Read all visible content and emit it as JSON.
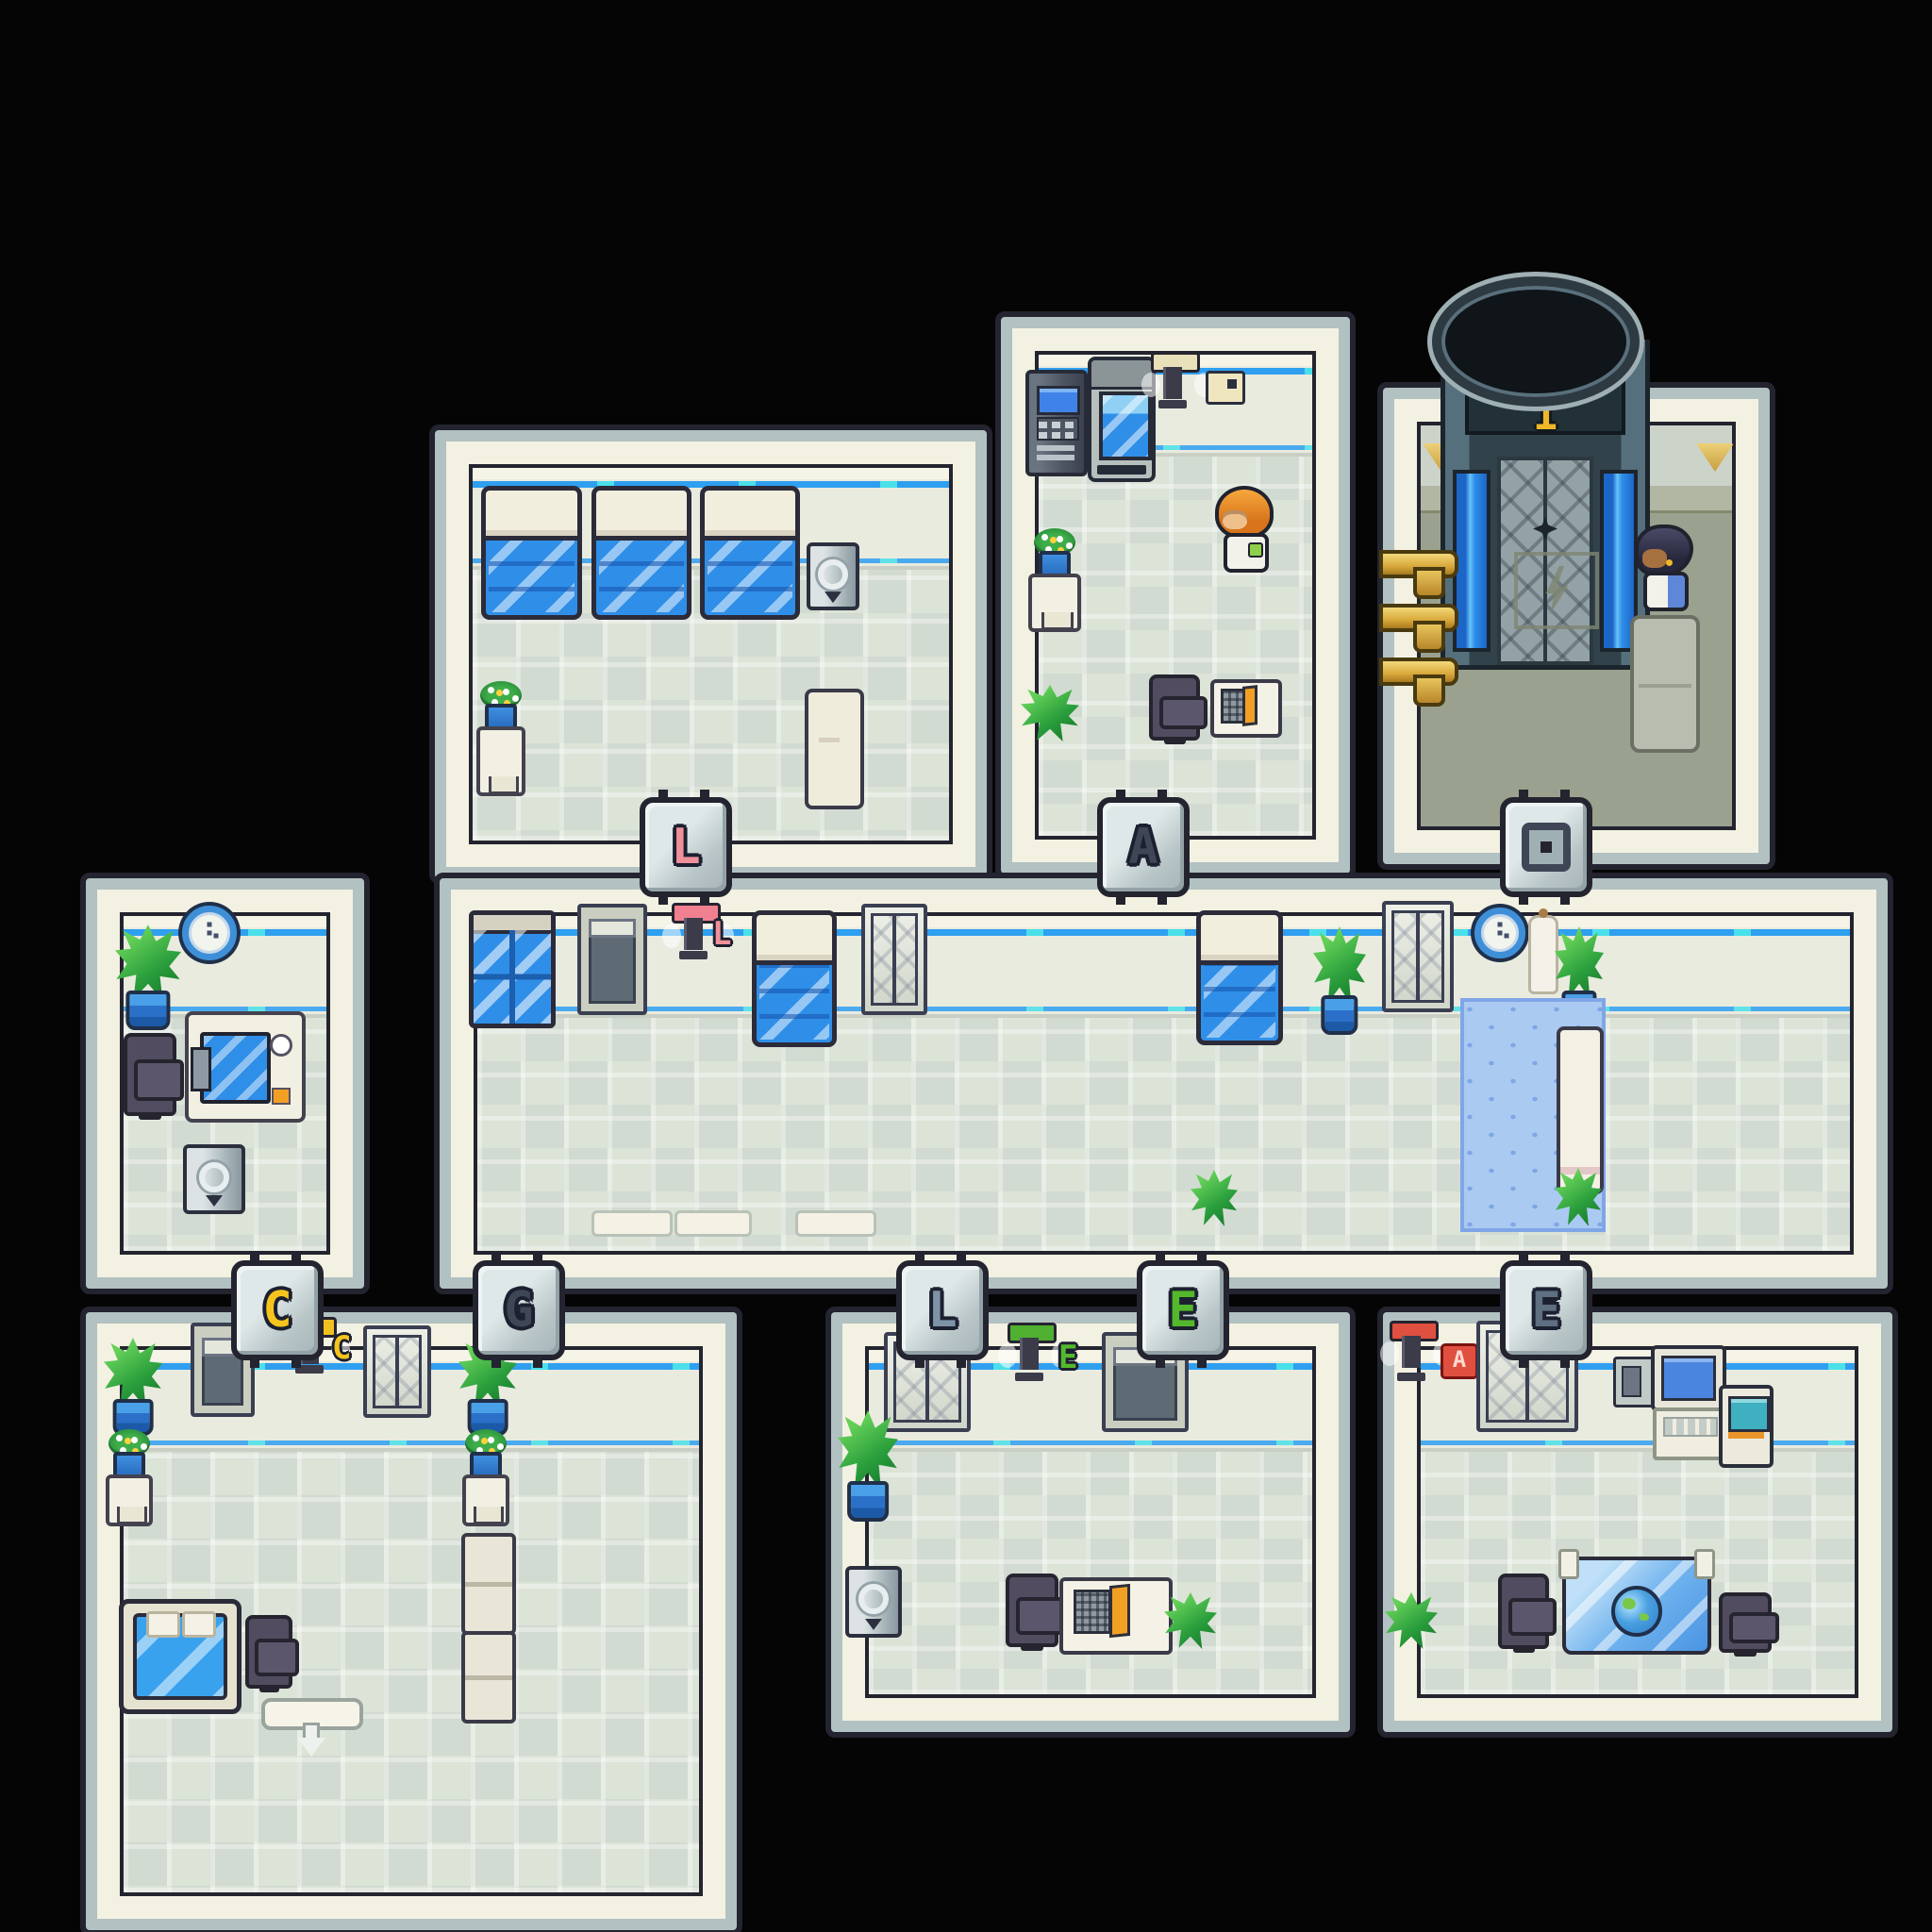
{
  "scene": {
    "type": "pixel-art facility floor map, top-down",
    "background_color": "#050505",
    "palette": {
      "wall_cream": "#f3f1e1",
      "frame_gray": "#b2c1c1",
      "outline_dark": "#23242f",
      "wall_stripe_blue": "#2f9ff0",
      "wall_stripe_cyan": "#49e0ea",
      "floor_tile": "#d6ded3",
      "elevator_hall_floor": "#9aa28f",
      "bed_blanket_blue": "#2f8fe8",
      "plant_green": "#2a9e3c",
      "pot_blue": "#2a70c8",
      "gold": "#d9a93c",
      "pool_blue": "#abcaf1"
    }
  },
  "elevator": {
    "floor_label": "1",
    "floor_plate_icon": "lightning-bolt"
  },
  "markers": {
    "top": [
      {
        "glyph": "L",
        "color": "#f0909a",
        "between": "ward and corridor"
      },
      {
        "glyph": "A",
        "color": "#3f4656",
        "between": "supply room and corridor"
      },
      {
        "glyph": "elevator-plate",
        "color": "#3f4656",
        "between": "elevator hall and corridor"
      }
    ],
    "bottom": [
      {
        "glyph": "C",
        "color": "#f6c51d",
        "between": "west office and lounge"
      },
      {
        "glyph": "G",
        "color": "#3f4656",
        "between": "corridor and lounge"
      },
      {
        "glyph": "L",
        "color": "#7e94a6",
        "between": "corridor and east office"
      },
      {
        "glyph": "E",
        "color": "#54b82d",
        "between": "corridor and east office"
      },
      {
        "glyph": "E",
        "color": "#5d6f80",
        "between": "corridor and computer lab"
      }
    ]
  },
  "signs": {
    "corridor": {
      "glyph": "L",
      "color": "#f0909a"
    },
    "lounge": {
      "glyph": "C",
      "color": "#f6c51d"
    },
    "office_east": {
      "glyph": "E",
      "color": "#54b82d"
    },
    "lab": {
      "glyph": "A",
      "color": "#ffd9d0",
      "plate_color": "#e05040"
    },
    "supply": {
      "glyph": "notice-plate",
      "color": "#efe6c0"
    }
  },
  "rooms": [
    {
      "id": "ward",
      "contents": [
        "bed x3",
        "medical machine",
        "flower table",
        "stretcher"
      ]
    },
    {
      "id": "supply-room",
      "contents": [
        "atm machine",
        "vending machine",
        "wall scanner (tan)",
        "notice sign",
        "flower table",
        "plant",
        "office chair",
        "reading desk"
      ],
      "npc": "orange-haired scientist"
    },
    {
      "id": "elevator-hall",
      "contents": [
        "cylindrical elevator labeled 1",
        "gold pipes x3",
        "lightning floor plate",
        "floor mat",
        "wall sconces"
      ],
      "npc": "dark-haired woman"
    },
    {
      "id": "office-west",
      "contents": [
        "wall clock",
        "plant",
        "office chair",
        "laptop desk with mug",
        "medical machine"
      ]
    },
    {
      "id": "corridor",
      "contents": [
        "window",
        "dark door",
        "wall scanner (pink)",
        "bed x2",
        "elevator doors x2",
        "plant x4",
        "wall clock",
        "coat stand",
        "pool mat",
        "bench",
        "thresholds x3"
      ]
    },
    {
      "id": "lounge",
      "contents": [
        "plant x2",
        "dark door",
        "wall scanner (yellow)",
        "elevator doors",
        "flower table x2",
        "bench x2",
        "bed with pillows",
        "office chair",
        "exit with down arrow"
      ]
    },
    {
      "id": "office-east",
      "contents": [
        "elevator doors",
        "wall scanner (green)",
        "dark door",
        "plant x2",
        "medical machine",
        "office chair",
        "reading desk"
      ]
    },
    {
      "id": "computer-lab",
      "contents": [
        "wall scanner (red)",
        "elevator doors",
        "wall phone",
        "computer monitor with keyboard desk",
        "kiosk",
        "glass globe table",
        "office chair x2",
        "plant"
      ]
    }
  ],
  "scanner_caps": [
    {
      "room": "supply-room",
      "color": "#e8e0b8"
    },
    {
      "room": "corridor",
      "color": "#f08090"
    },
    {
      "room": "lounge",
      "color": "#f0c020"
    },
    {
      "room": "office-east",
      "color": "#50b030"
    },
    {
      "room": "computer-lab",
      "color": "#e05040"
    }
  ]
}
